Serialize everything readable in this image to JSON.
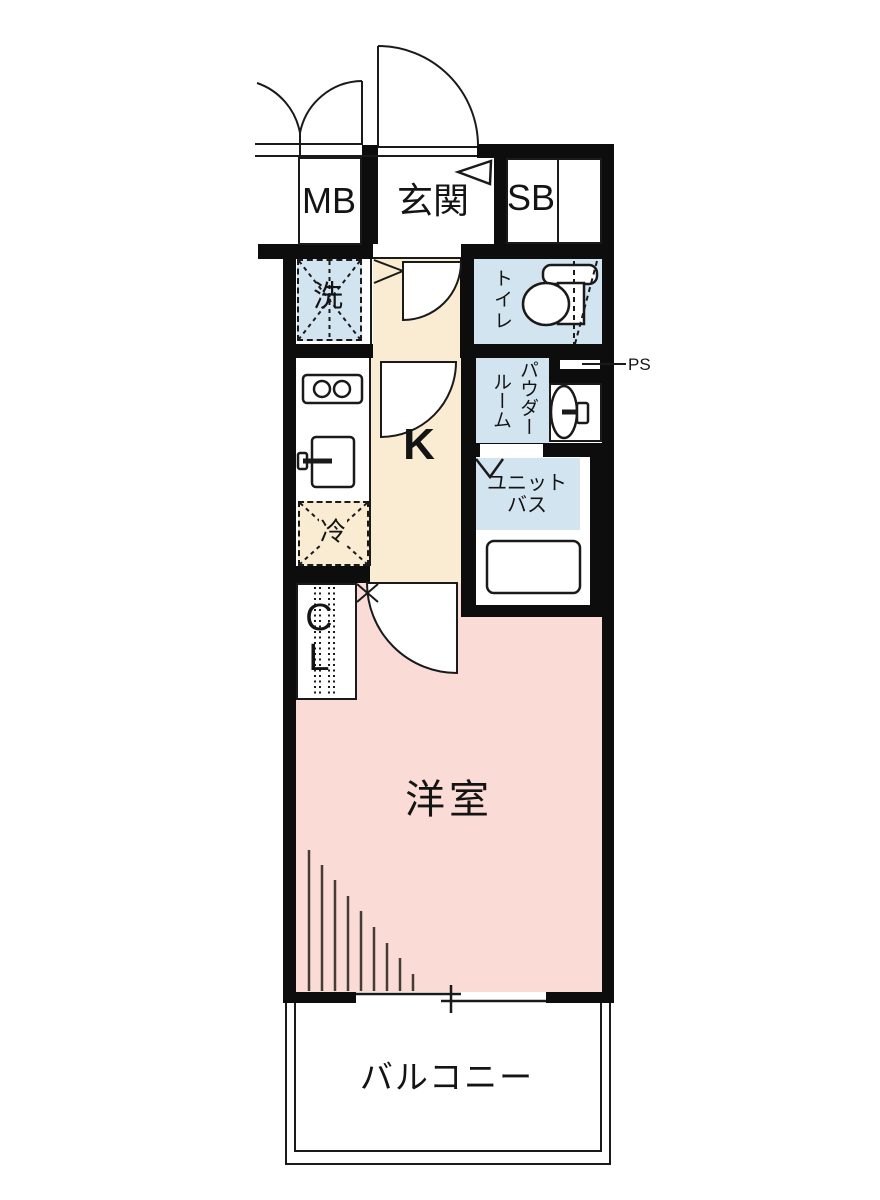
{
  "floorplan": {
    "rooms": {
      "meter_box": {
        "label": "MB"
      },
      "entrance": {
        "label": "玄関"
      },
      "shoe_box": {
        "label": "SB"
      },
      "laundry": {
        "label": "洗"
      },
      "toilet": {
        "label": "トイレ"
      },
      "kitchen": {
        "label": "K"
      },
      "powder_room": {
        "label_line1": "パウダー",
        "label_line2": "ルーム"
      },
      "pipe_space": {
        "label": "PS"
      },
      "unit_bath": {
        "label_line1": "ユニット",
        "label_line2": "バス"
      },
      "refrigerator": {
        "label": "冷"
      },
      "closet": {
        "label_line1": "C",
        "label_line2": "L"
      },
      "western_room": {
        "label": "洋室"
      },
      "balcony": {
        "label": "バルコニー"
      }
    },
    "colors": {
      "wall": "#0d0d0d",
      "kitchen_floor": "#f9ecd2",
      "room_floor": "#fadbd6",
      "wet_area": "#d3e4f1",
      "line": "#1a1a1a",
      "hatch": "#473b35"
    }
  }
}
